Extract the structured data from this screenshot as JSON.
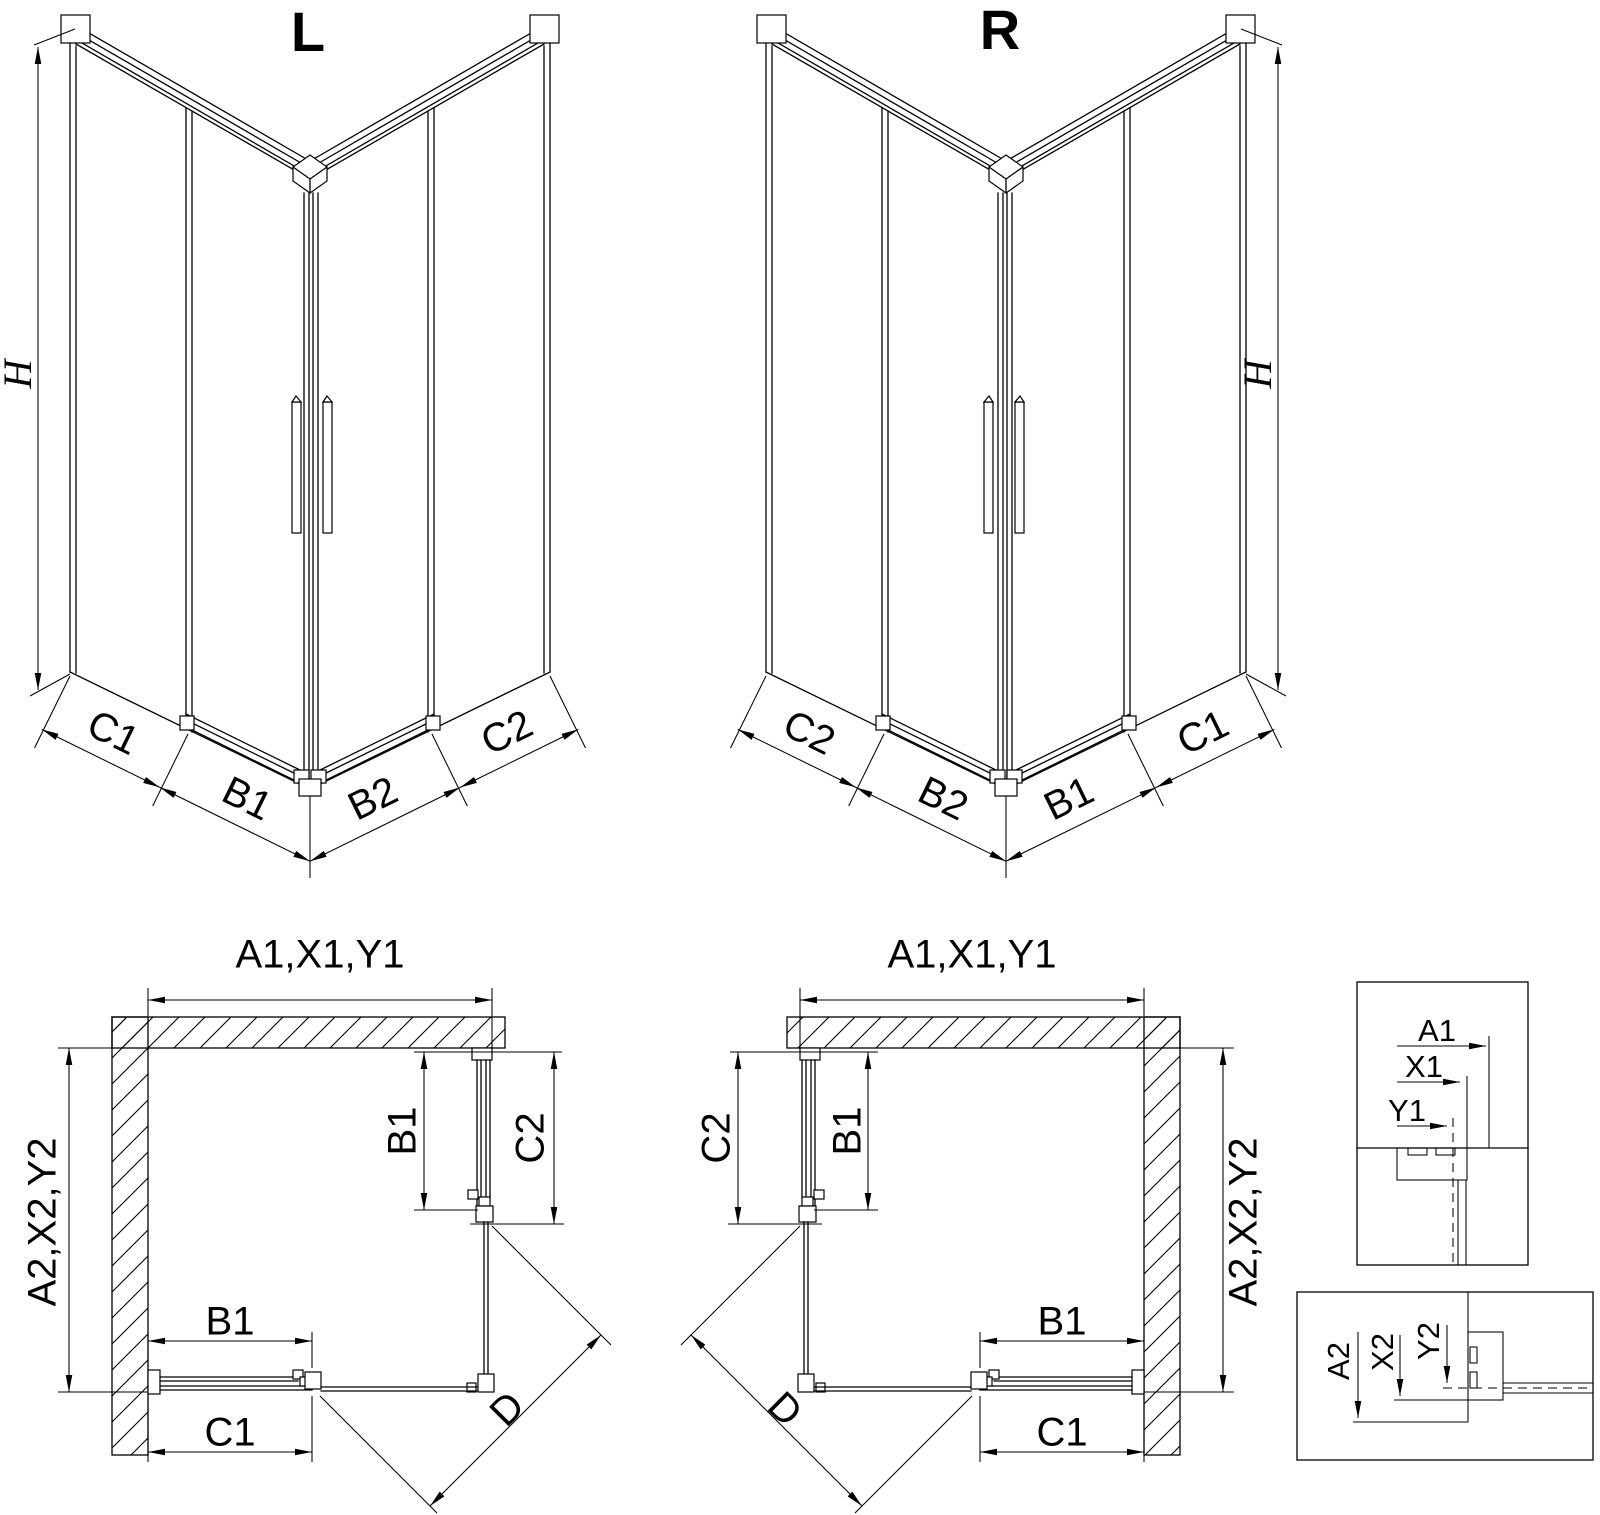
{
  "drawing": {
    "background_color": "#ffffff",
    "line_color": "#000000"
  },
  "iso_left": {
    "title": "L",
    "height_label": "H",
    "width_labels": [
      "C1",
      "B1",
      "B2",
      "C2"
    ]
  },
  "iso_right": {
    "title": "R",
    "height_label": "H",
    "width_labels": [
      "C2",
      "B2",
      "B1",
      "C1"
    ]
  },
  "plan_left": {
    "overall_width_label": "A1,X1,Y1",
    "overall_depth_label": "A2,X2,Y2",
    "door_side_label": "B1",
    "panel_side_label": "C2",
    "door_front_label": "B1",
    "panel_front_label": "C1",
    "diagonal_label": "D"
  },
  "plan_right": {
    "overall_width_label": "A1,X1,Y1",
    "overall_depth_label": "A2,X2,Y2",
    "door_side_label": "B1",
    "panel_side_label": "C2",
    "door_front_label": "B1",
    "panel_front_label": "C1",
    "diagonal_label": "D"
  },
  "detail_width": {
    "labels": [
      "A1",
      "X1",
      "Y1"
    ]
  },
  "detail_depth": {
    "labels": [
      "A2",
      "X2",
      "Y2"
    ]
  }
}
